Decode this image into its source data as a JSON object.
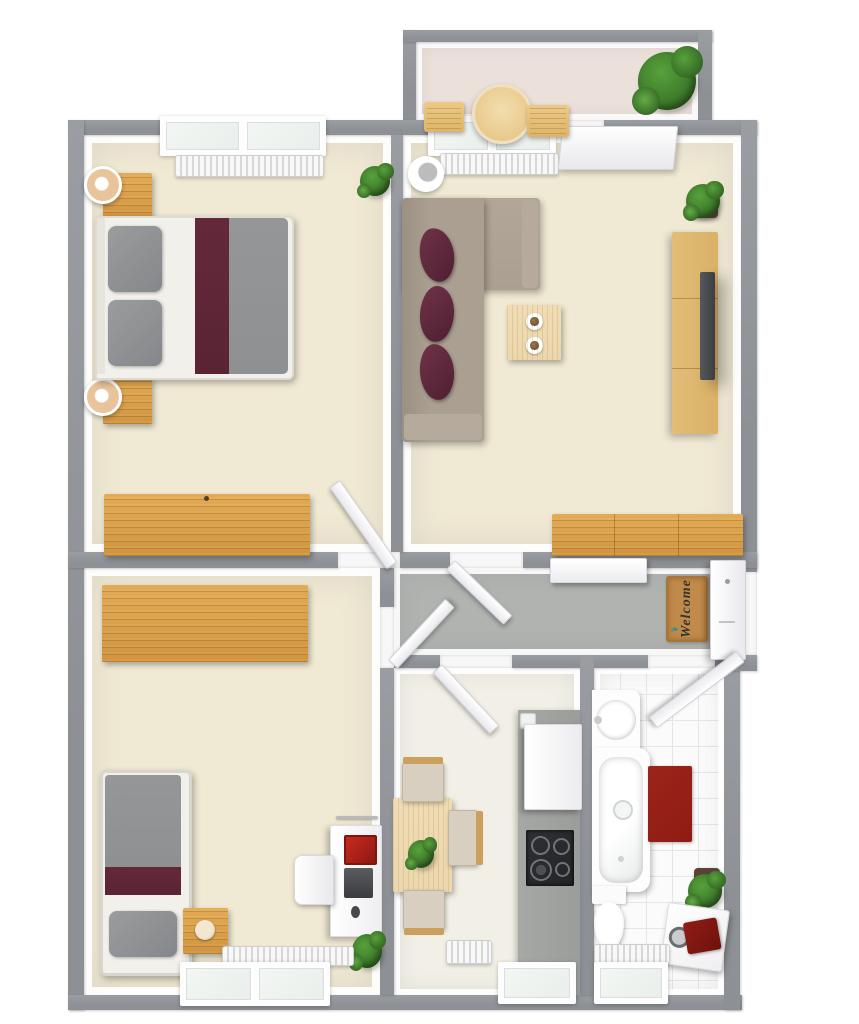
{
  "scene": {
    "type": "3d-floor-plan-top-down-render",
    "background": "#ffffff",
    "visible_text": [
      "Welcome"
    ]
  },
  "welcome_mat": {
    "text": "Welcome",
    "icon": "bird-icon"
  },
  "palette": {
    "wall": "#8d9094",
    "wall-light": "#9a9da1",
    "floor-cream": "#f0e9d3",
    "floor-hall": "#b0b3b0",
    "floor-kitchen": "#f2f0e6",
    "floor-balcony": "#ebe0da",
    "tile": "#fbfbfb",
    "grout": "#e6e6e6",
    "wood": "#dca04e",
    "wood-dark": "#b97f35",
    "wood-light": "#ecd7ad",
    "wood-mid": "#d9b267",
    "sofa": "#ab9f91",
    "sofa-dark": "#968b7d",
    "maroon": "#5e2a3c",
    "bed-gray": "#8e9092",
    "bed-maroon": "#5a2434",
    "linen": "#f2f0ea",
    "rug-red": "#8e1c14",
    "counter": "#9b9d9b",
    "cooktop": "#222426",
    "plant": "#3f7d2c",
    "plant-light": "#57a13b",
    "pot": "#5b4238",
    "radiator": "#f4f4f4",
    "door-white": "#fbfbfb",
    "glass": "#e8eeeb",
    "accent-red": "#b3221a",
    "mat": "#c08a4a",
    "mat-text": "#35352d",
    "mat-icon": "#2c8f96"
  },
  "rooms": {
    "bedroom_main": {
      "name": "bedroom-main",
      "furniture": [
        "double-bed",
        "nightstand-top",
        "nightstand-bottom",
        "table-lamp-top",
        "table-lamp-bottom",
        "wardrobe",
        "plant",
        "radiator",
        "double-window",
        "door"
      ]
    },
    "living_room": {
      "name": "living-room",
      "furniture": [
        "corner-sofa",
        "throw-pillows-x3",
        "floor-lamp",
        "coffee-table-with-cups",
        "tv-sideboard",
        "tv",
        "plant",
        "sideboard",
        "radiator",
        "window",
        "balcony-door"
      ]
    },
    "balcony": {
      "name": "balcony",
      "furniture": [
        "round-table",
        "chair-left",
        "chair-right",
        "large-plant"
      ]
    },
    "hallway": {
      "name": "hallway",
      "furniture": [
        "welcome-mat",
        "shoe-cabinet",
        "entrance-door"
      ]
    },
    "bedroom_small": {
      "name": "bedroom-small",
      "furniture": [
        "single-bed",
        "nightstand-with-clock",
        "wardrobe",
        "desk",
        "desk-chair",
        "laptop",
        "red-notebook",
        "desk-lamp",
        "plant",
        "radiator",
        "double-window",
        "door"
      ]
    },
    "kitchen": {
      "name": "kitchen",
      "furniture": [
        "dining-table",
        "table-plant",
        "chair-top",
        "chair-right",
        "chair-bottom",
        "counter",
        "tall-cabinet",
        "cooktop",
        "radiator",
        "window",
        "door"
      ]
    },
    "bathroom": {
      "name": "bathroom",
      "furniture": [
        "washbasin",
        "bathtub",
        "red-rug",
        "toilet",
        "washing-machine",
        "red-towel",
        "wall-plant",
        "radiator",
        "window",
        "door"
      ]
    }
  }
}
